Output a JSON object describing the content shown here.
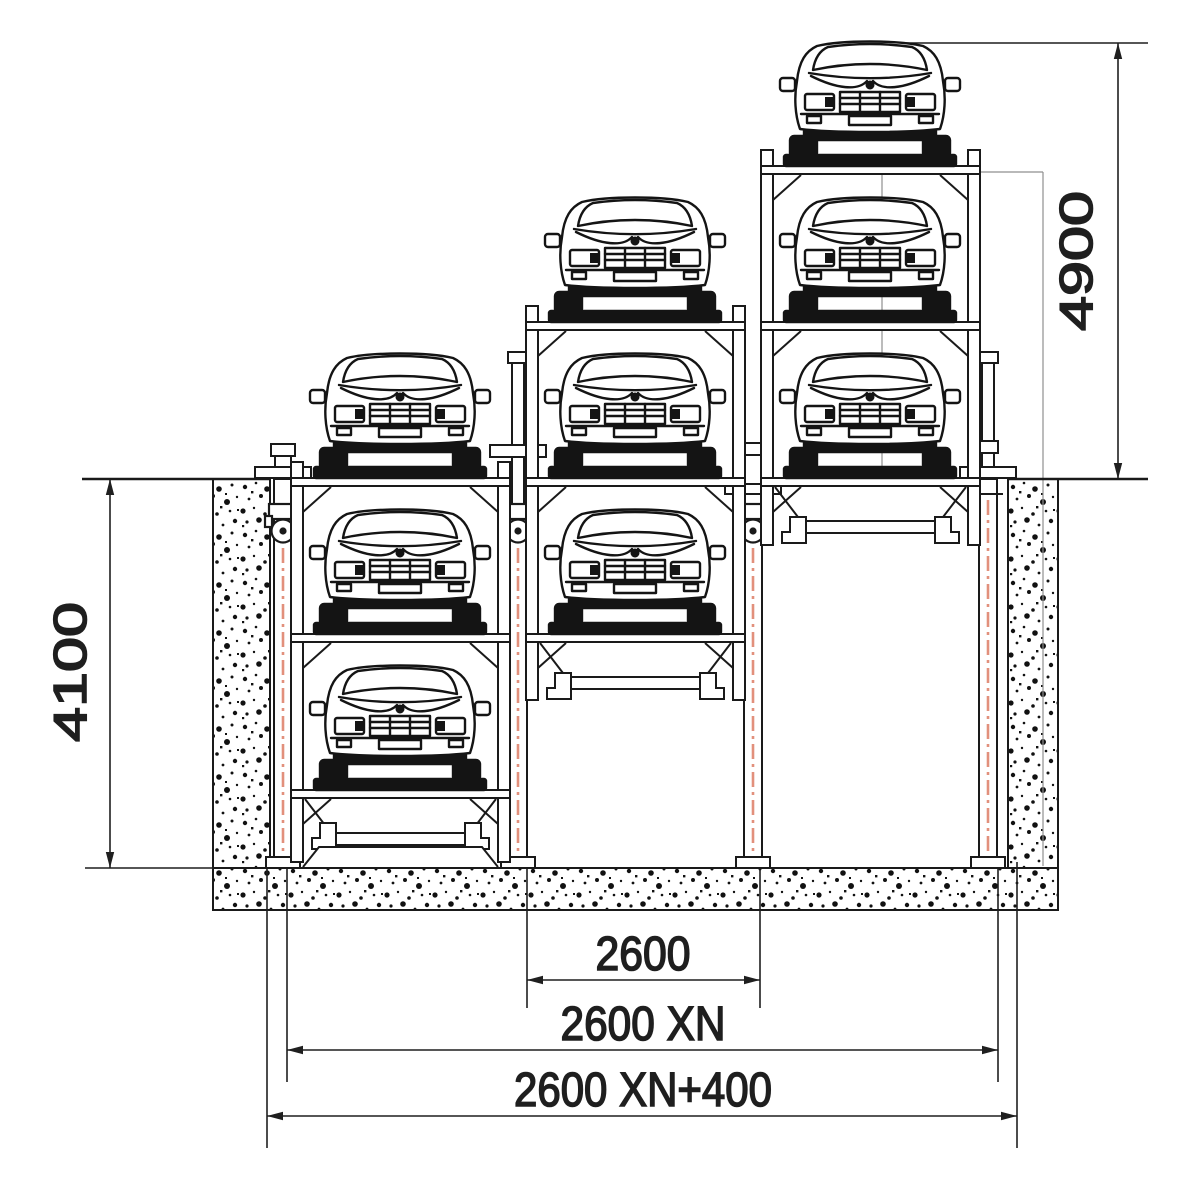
{
  "drawing": {
    "title": "Pit type three-level mechanical puzzle parking system - sectional elevation",
    "colors": {
      "line": "#1a1a1a",
      "hydraulic_line": "#e2907c",
      "thin_reference": "#8f8f8f",
      "background": "#ffffff"
    },
    "dimensions": {
      "height_above_ground": {
        "label": "4900",
        "orientation": "vertical",
        "side": "right"
      },
      "pit_depth": {
        "label": "4100",
        "orientation": "vertical",
        "side": "left"
      },
      "bay_width": {
        "label": "2600",
        "orientation": "horizontal"
      },
      "total_bays_width": {
        "label": "2600 XN",
        "orientation": "horizontal"
      },
      "overall_width": {
        "label": "2600 XN+400",
        "orientation": "horizontal"
      }
    },
    "stacks": [
      {
        "name": "left",
        "cars": 3,
        "levels_above_ground": 1,
        "levels_in_pit": 2
      },
      {
        "name": "middle",
        "cars": 3,
        "levels_above_ground": 2,
        "levels_in_pit": 1
      },
      {
        "name": "right",
        "cars": 3,
        "levels_above_ground": 3,
        "levels_in_pit": 0
      }
    ],
    "icons": {
      "car": "car-front-icon",
      "post": "hydraulic-post-icon",
      "pulley": "pulley-icon"
    }
  }
}
